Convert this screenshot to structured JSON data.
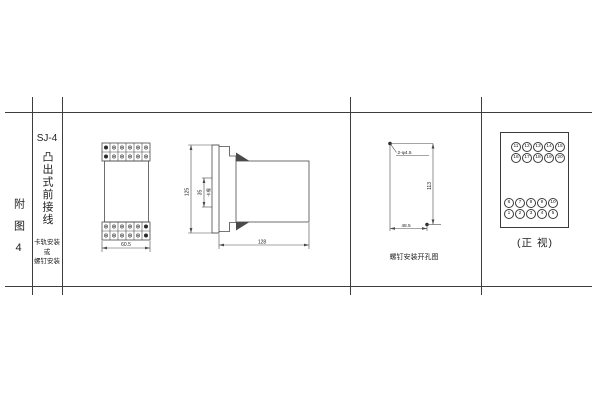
{
  "figure_label": "附图4",
  "model_column": {
    "model": "SJ-4",
    "mount_title": "凸出式前接线",
    "mount_note_1": "卡轨安装",
    "mount_note_2": "或",
    "mount_note_3": "螺钉安装"
  },
  "front_view": {
    "width_dim": "60.5"
  },
  "side_view": {
    "height_dim": "125",
    "slot_dim": "35",
    "slot_label": "卡槽",
    "depth_dim": "128"
  },
  "drill_view": {
    "hole_label": "2-φ4.5",
    "vertical_dim": "113",
    "horizontal_dim": "48.5",
    "caption": "螺钉安装开孔图"
  },
  "terminal_view": {
    "top_row_1": [
      "11",
      "12",
      "13",
      "14",
      "15"
    ],
    "top_row_2": [
      "16",
      "17",
      "18",
      "19",
      "20"
    ],
    "bottom_row_1": [
      "6",
      "7",
      "8",
      "9",
      "10"
    ],
    "bottom_row_2": [
      "1",
      "2",
      "3",
      "4",
      "5"
    ],
    "caption": "(正 视)"
  },
  "colors": {
    "line": "#3d3d3d",
    "text": "#222222",
    "background": "#ffffff"
  }
}
